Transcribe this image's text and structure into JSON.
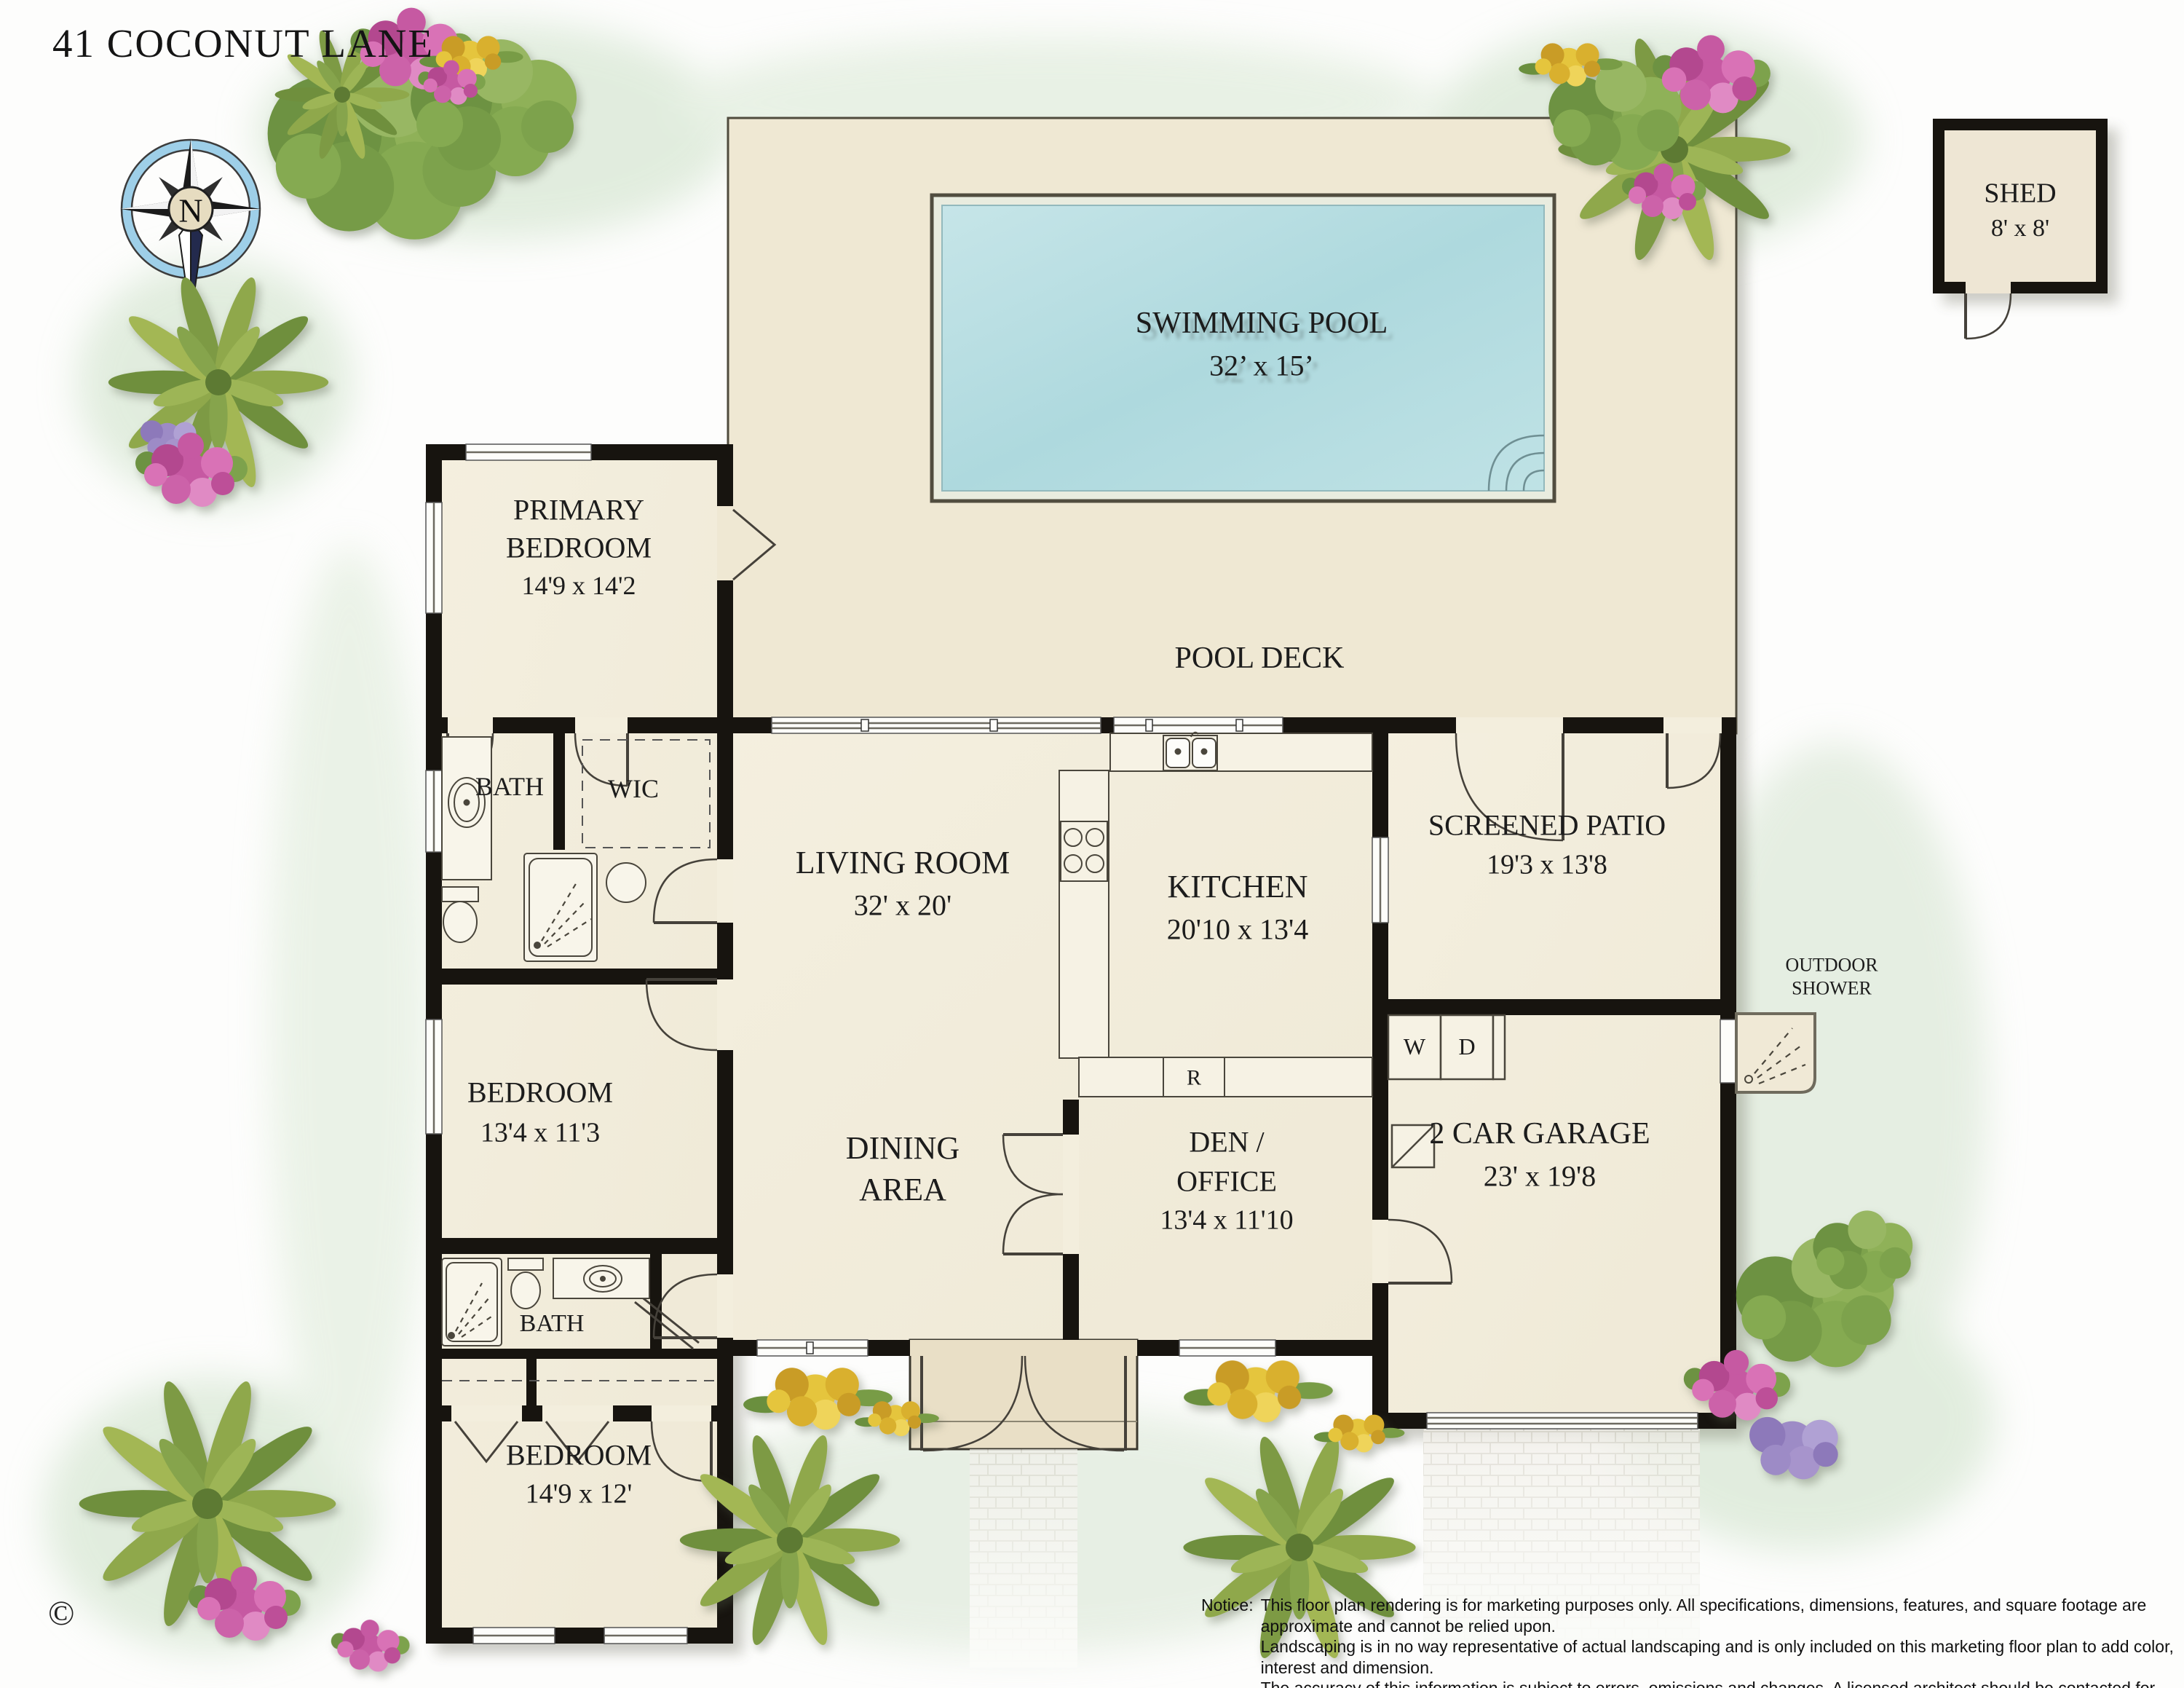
{
  "title": "41 COCONUT LANE",
  "compass": {
    "north_label": "N"
  },
  "shed": {
    "name": "SHED",
    "dims": "8' x 8'"
  },
  "pool": {
    "name": "SWIMMING POOL",
    "dims": "32’ x 15’"
  },
  "pool_deck_label": "POOL DECK",
  "rooms": {
    "primary_bedroom": {
      "line1": "PRIMARY",
      "line2": "BEDROOM",
      "dims": "14'9 x 14'2"
    },
    "bath1": {
      "name": "BATH"
    },
    "wic": {
      "name": "WIC"
    },
    "living_room": {
      "name": "LIVING ROOM",
      "dims": "32' x 20'"
    },
    "kitchen": {
      "name": "KITCHEN",
      "dims": "20'10 x 13'4"
    },
    "screened_patio": {
      "name": "SCREENED PATIO",
      "dims": "19'3 x 13'8"
    },
    "bedroom2": {
      "name": "BEDROOM",
      "dims": "13'4 x 11'3"
    },
    "dining": {
      "line1": "DINING",
      "line2": "AREA"
    },
    "den_office": {
      "line1": "DEN /",
      "line2": "OFFICE",
      "dims": "13'4 x 11'10"
    },
    "garage": {
      "name": "2 CAR GARAGE",
      "dims": "23' x 19'8"
    },
    "bath2": {
      "name": "BATH"
    },
    "bedroom3": {
      "name": "BEDROOM",
      "dims": "14'9 x 12'"
    }
  },
  "outdoor_shower": {
    "line1": "OUTDOOR",
    "line2": "SHOWER"
  },
  "appliances": {
    "washer": "W",
    "dryer": "D",
    "refrigerator": "R"
  },
  "copyright_symbol": "©",
  "notice": {
    "label": "Notice:",
    "lines": [
      "This floor plan rendering is for marketing purposes only. All specifications, dimensions, features, and square footage are approximate and cannot be relied upon.",
      "Landscaping is in no way representative of actual landscaping and is only included on this marketing floor plan to add color, interest and dimension.",
      "The accuracy of this information is subject to errors, omissions and changes. A licensed architect should be contacted for actual measurements, features and specifications."
    ]
  },
  "colors": {
    "wall": "#17140f",
    "pool_water": "#b2dbe0",
    "deck": "#efe8d3",
    "room": "#f3eedd",
    "porch": "#e9dfc6",
    "compass_ring": "#9ecfe8",
    "lawn_wash": "#d6e6d2"
  }
}
